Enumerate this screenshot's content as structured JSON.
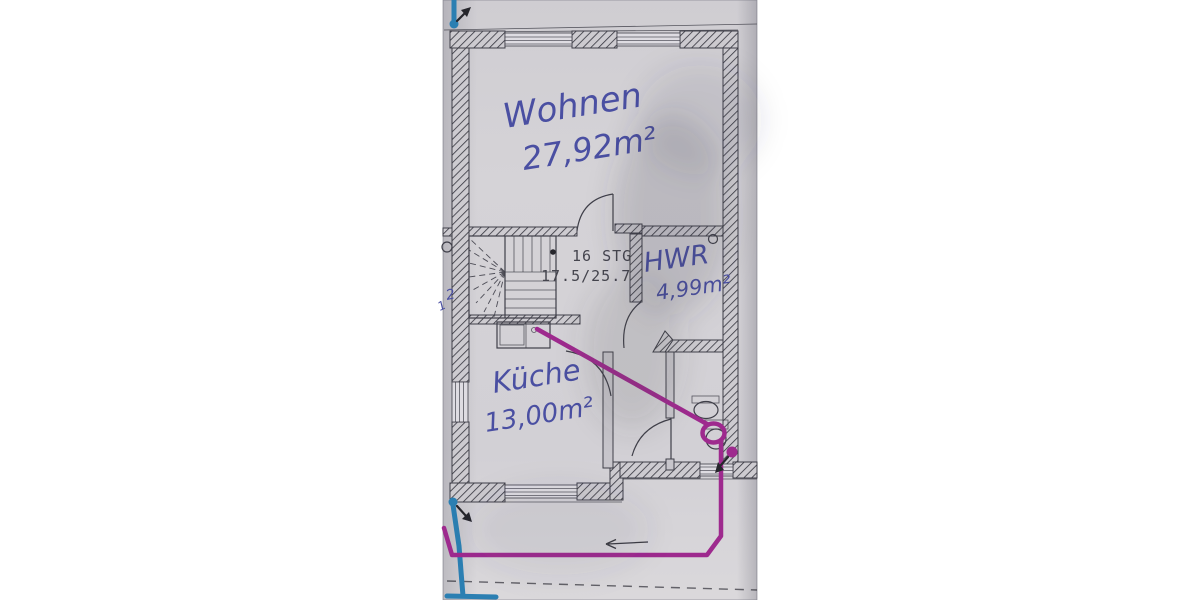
{
  "photo": {
    "rooms": [
      {
        "name": "Wohnen",
        "area": "27,92m²"
      },
      {
        "name": "HWR",
        "area": "4,99m²"
      },
      {
        "name": "Küche",
        "area": "13,00m²"
      }
    ],
    "stair_note": {
      "line1": "16 STG",
      "line2": "17.5/25.7"
    },
    "edge_marks": [
      "2",
      "1"
    ]
  },
  "colors": {
    "background": "#ffffff",
    "paper": "#d4d2d6",
    "paper_light": "#dbd9dd",
    "plan_line": "#3f3f49",
    "wall_dark": "#2e2e36",
    "ink_blue": "#4a4fa2",
    "ink_black": "#26262c",
    "print_gray": "#45454e",
    "marker_magenta": "#9e2a8e",
    "marker_teal": "#2b7fb2"
  }
}
